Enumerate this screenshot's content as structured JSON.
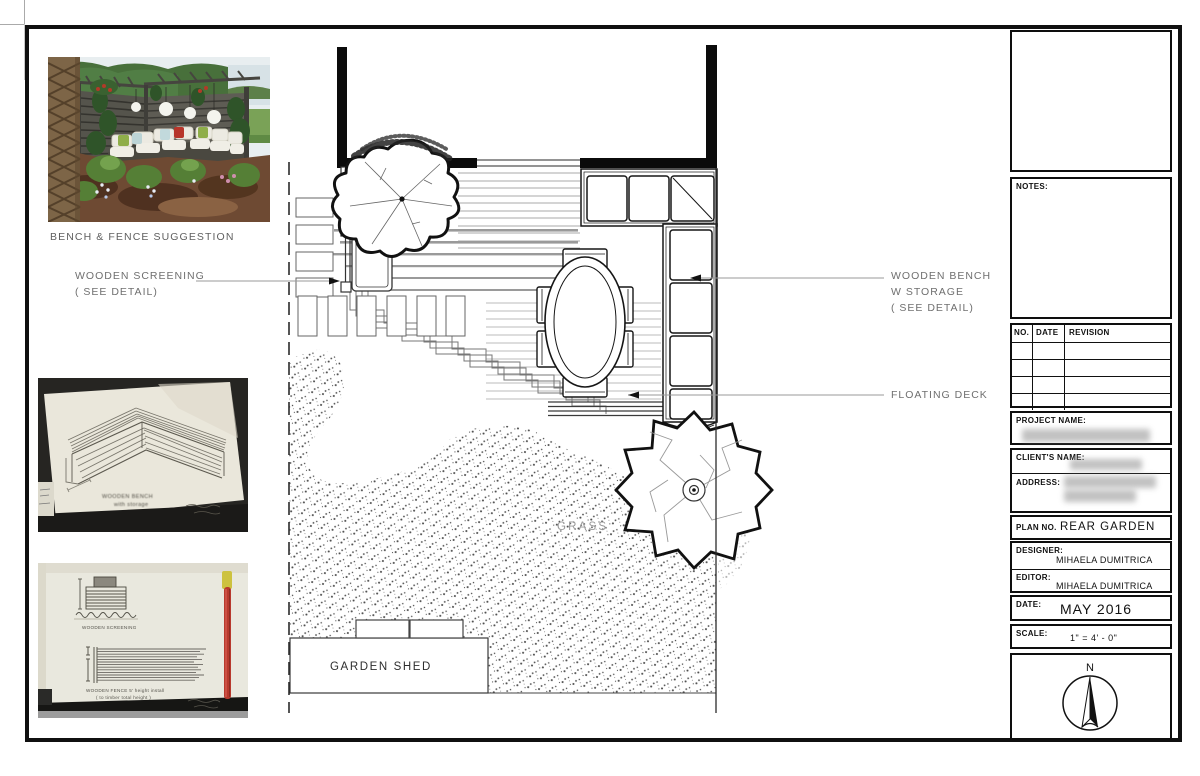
{
  "photo_caption": "BENCH & FENCE SUGGESTION",
  "plan_labels": {
    "screening_line1": "WOODEN SCREENING",
    "screening_line2": "( SEE DETAIL)",
    "bench_line1": "WOODEN BENCH",
    "bench_line2": "W STORAGE",
    "bench_line3": "( SEE DETAIL)",
    "floating_deck": "FLOATING DECK",
    "grass": "GRASS",
    "garden_shed": "GARDEN SHED"
  },
  "sketch_notes": {
    "bench_caption_line1": "WOODEN BENCH",
    "bench_caption_line2": "with storage",
    "screening_caption": "WOODEN SCREENING",
    "fence_caption_line1": "WOODEN FENCE  5' height install",
    "fence_caption_line2": "( to timber total height )"
  },
  "title_block": {
    "notes_label": "NOTES:",
    "revision_headers": {
      "no": "NO.",
      "date": "DATE",
      "revision": "REVISION"
    },
    "project_name_label": "PROJECT NAME:",
    "clients_name_label": "CLIENT'S NAME:",
    "address_label": "ADDRESS:",
    "plan_no_label": "PLAN NO.",
    "plan_no_value": "REAR GARDEN",
    "designer_label": "DESIGNER:",
    "designer_value": "MIHAELA DUMITRICA",
    "editor_label": "EDITOR:",
    "editor_value": "MIHAELA DUMITRICA",
    "date_label": "DATE:",
    "date_value": "MAY 2016",
    "scale_label": "SCALE:",
    "scale_value": "1\" = 4' - 0\"",
    "compass_north": "N"
  }
}
